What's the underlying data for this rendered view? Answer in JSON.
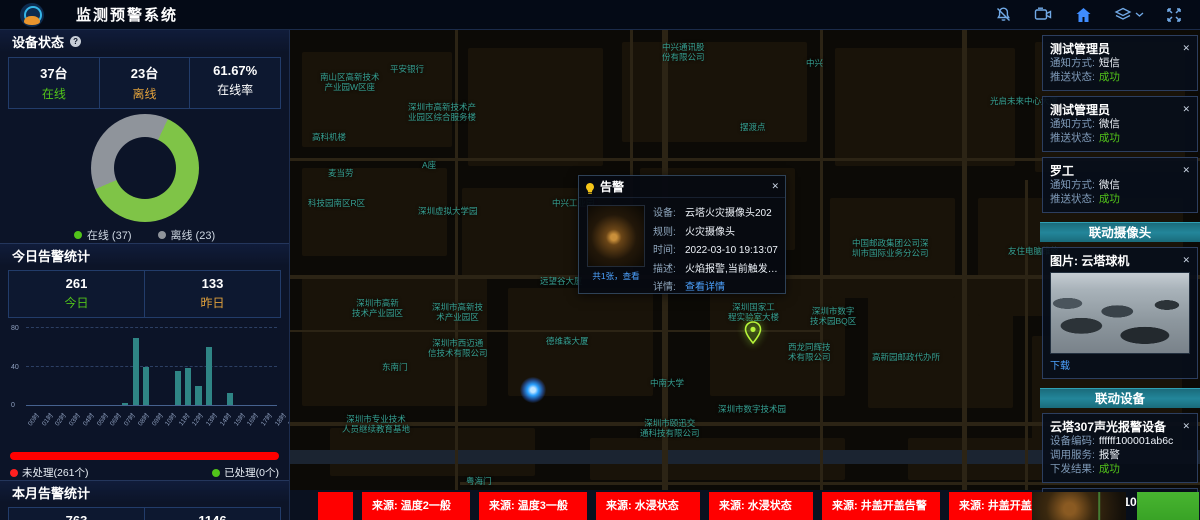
{
  "app": {
    "title": "监测预警系统"
  },
  "header": {
    "icons": [
      "notifications-muted-icon",
      "video-camera-icon",
      "home-icon",
      "layers-icon",
      "chevron-down-icon",
      "fullscreen-icon"
    ]
  },
  "device_status": {
    "title": "设备状态",
    "stats": [
      {
        "value": "37台",
        "label": "在线",
        "color": "#52c41a"
      },
      {
        "value": "23台",
        "label": "离线",
        "color": "#e2a23c"
      },
      {
        "value": "61.67%",
        "label": "在线率",
        "color": "#ffffff"
      }
    ],
    "donut": {
      "online": 37,
      "offline": 23,
      "online_pct": 61.67,
      "online_color": "#7fc447",
      "offline_color": "#8f949b"
    },
    "legend": [
      {
        "label": "在线 (37)",
        "color": "#52c41a"
      },
      {
        "label": "离线 (23)",
        "color": "#8f949b"
      }
    ]
  },
  "today_alerts": {
    "title": "今日告警统计",
    "stats": [
      {
        "value": "261",
        "label": "今日",
        "color": "#52c41a"
      },
      {
        "value": "133",
        "label": "昨日",
        "color": "#e2a23c"
      }
    ],
    "chart_data": {
      "type": "bar",
      "categories": [
        "00时",
        "01时",
        "02时",
        "03时",
        "04时",
        "05时",
        "06时",
        "07时",
        "08时",
        "09时",
        "10时",
        "11时",
        "12时",
        "13时",
        "14时",
        "15时",
        "16时",
        "17时",
        "18时",
        "19时",
        "20时",
        "21时",
        "22时",
        "23时"
      ],
      "values": [
        0,
        0,
        0,
        0,
        0,
        0,
        0,
        0,
        0,
        2,
        70,
        40,
        0,
        0,
        35,
        38,
        20,
        60,
        0,
        13,
        0,
        0,
        0,
        0
      ],
      "title": "今日告警统计",
      "xlabel": "",
      "ylabel": "",
      "ylim": [
        0,
        80
      ],
      "yticks": [
        0,
        40,
        80
      ],
      "bar_color": "#2f8585",
      "grid": true,
      "legend_position": "none"
    },
    "progress": {
      "bar_color": "#ff0000",
      "unprocessed_label": "未处理(261个)",
      "unprocessed_color": "#ff2020",
      "processed_label": "已处理(0个)",
      "processed_color": "#52c41a"
    }
  },
  "month_alerts": {
    "title": "本月告警统计",
    "stats": [
      {
        "value": "763",
        "label": "",
        "color": "#ffffff"
      },
      {
        "value": "1146",
        "label": "",
        "color": "#ffffff"
      }
    ]
  },
  "map": {
    "labels": [
      {
        "text": "中兴通讯股\n份有限公司",
        "x": 372,
        "y": 12
      },
      {
        "text": "中兴",
        "x": 516,
        "y": 28
      },
      {
        "text": "平安银行",
        "x": 100,
        "y": 34
      },
      {
        "text": "南山区高新技术\n产业园W区座",
        "x": 30,
        "y": 42
      },
      {
        "text": "光启未来中心大厦",
        "x": 700,
        "y": 66
      },
      {
        "text": "深圳市高新技术产\n业园区综合服务楼",
        "x": 118,
        "y": 72
      },
      {
        "text": "高科机楼",
        "x": 22,
        "y": 102
      },
      {
        "text": "摆渡点",
        "x": 450,
        "y": 92
      },
      {
        "text": "A座",
        "x": 132,
        "y": 130
      },
      {
        "text": "麦当劳",
        "x": 38,
        "y": 138
      },
      {
        "text": "科技园南区R区",
        "x": 18,
        "y": 168
      },
      {
        "text": "中兴工业园",
        "x": 262,
        "y": 168
      },
      {
        "text": "深圳虚拟大学园",
        "x": 128,
        "y": 176
      },
      {
        "text": "中国邮政集团公司深\n圳市国际业务分公司",
        "x": 562,
        "y": 208
      },
      {
        "text": "友住电脑维修",
        "x": 718,
        "y": 216
      },
      {
        "text": "远望谷大厦",
        "x": 250,
        "y": 246
      },
      {
        "text": "深圳市高新\n技术产业园区",
        "x": 62,
        "y": 268
      },
      {
        "text": "深圳市高新技\n术产业园区",
        "x": 142,
        "y": 272
      },
      {
        "text": "深圳国家工\n程实验室大楼",
        "x": 438,
        "y": 272
      },
      {
        "text": "深圳市数字\n技术园BQ区",
        "x": 520,
        "y": 276
      },
      {
        "text": "德维森大厦",
        "x": 256,
        "y": 306
      },
      {
        "text": "深圳市西迈通\n信技术有限公司",
        "x": 138,
        "y": 308
      },
      {
        "text": "西龙同辉技\n术有限公司",
        "x": 498,
        "y": 312
      },
      {
        "text": "高新园邮政代办所",
        "x": 582,
        "y": 322
      },
      {
        "text": "东南门",
        "x": 92,
        "y": 332
      },
      {
        "text": "中南大学",
        "x": 360,
        "y": 348
      },
      {
        "text": "深圳市数字技术园",
        "x": 428,
        "y": 374
      },
      {
        "text": "深圳市专业技术\n人员继续教育基地",
        "x": 52,
        "y": 384
      },
      {
        "text": "深圳市颐迅交\n通科技有限公司",
        "x": 350,
        "y": 388
      },
      {
        "text": "粤海门",
        "x": 176,
        "y": 446
      }
    ],
    "marker_pin": {
      "x": 452,
      "y": 290
    },
    "marker_dot": {
      "x": 230,
      "y": 347
    },
    "popup": {
      "title": "告警",
      "image_caption": "共1张，查看",
      "fields": [
        {
          "label": "设备:",
          "value": "云塔火灾摄像头202"
        },
        {
          "label": "规则:",
          "value": "火灾摄像头"
        },
        {
          "label": "时间:",
          "value": "2022-03-10 19:13:07"
        },
        {
          "label": "描述:",
          "value": "火焰报警,当前触发值为..."
        },
        {
          "label": "详情:",
          "value": "查看详情",
          "link": true
        }
      ]
    }
  },
  "notifications": [
    {
      "title": "测试管理员",
      "rows": [
        {
          "label": "通知方式:",
          "value": "短信"
        },
        {
          "label": "推送状态:",
          "value": "成功",
          "color": "#52c41a"
        }
      ]
    },
    {
      "title": "测试管理员",
      "rows": [
        {
          "label": "通知方式:",
          "value": "微信"
        },
        {
          "label": "推送状态:",
          "value": "成功",
          "color": "#52c41a"
        }
      ]
    },
    {
      "title": "罗工",
      "rows": [
        {
          "label": "通知方式:",
          "value": "微信"
        },
        {
          "label": "推送状态:",
          "value": "成功",
          "color": "#52c41a"
        }
      ]
    }
  ],
  "linkage_camera": {
    "header": "联动摄像头",
    "card": {
      "title": "图片: 云塔球机",
      "action": "下载"
    }
  },
  "linkage_devices": {
    "header": "联动设备",
    "cards": [
      {
        "title": "云塔307声光报警设备",
        "rows": [
          {
            "label": "设备编码:",
            "value": "ffffff100001ab6c"
          },
          {
            "label": "调用服务:",
            "value": "报警"
          },
          {
            "label": "下发结果:",
            "value": "成功",
            "color": "#52c41a"
          }
        ]
      },
      {
        "title": "SIP壁挂音箱1105",
        "rows": [
          {
            "label": "设备编码:",
            "value": "1105"
          }
        ]
      }
    ]
  },
  "ticker": {
    "color": "#ff0000",
    "items": [
      {
        "text": "",
        "width": 35
      },
      {
        "text": "来源: 温度2一般",
        "width": 108
      },
      {
        "text": "来源: 温度3一般",
        "width": 108
      },
      {
        "text": "来源: 水浸状态",
        "width": 104
      },
      {
        "text": "来源: 水浸状态",
        "width": 104
      },
      {
        "text": "来源: 井盖开盖告警",
        "width": 118
      },
      {
        "text": "来源: 井盖开盖告警",
        "width": 118
      }
    ]
  }
}
